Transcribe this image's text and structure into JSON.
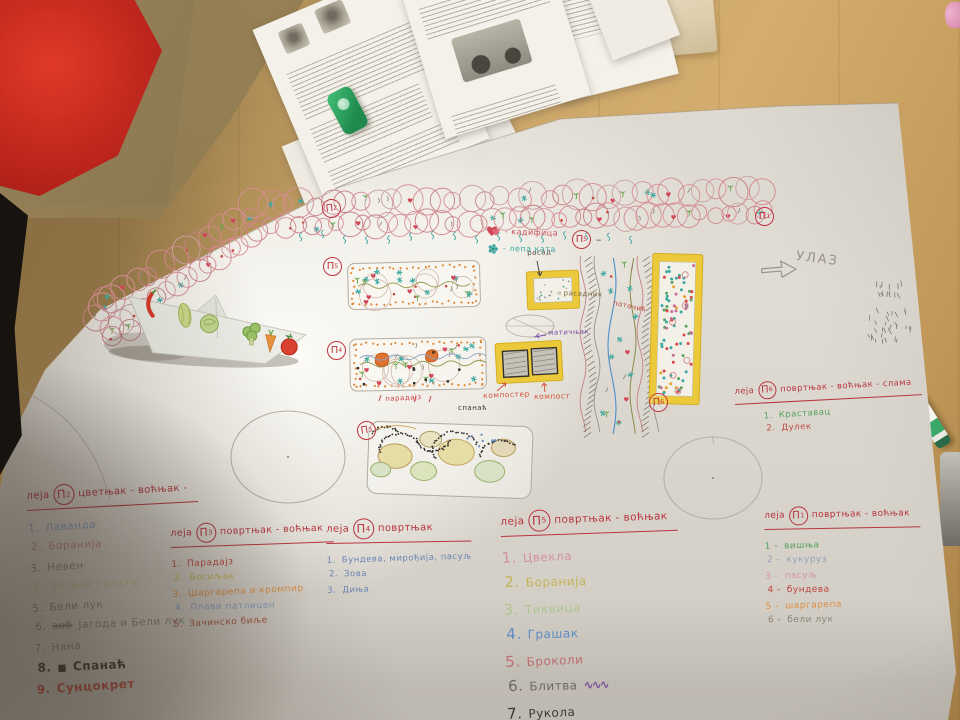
{
  "scene": {
    "desk_color": "#c9a466",
    "table_left_color": "#8a774e",
    "cloth_color": "#b5221a",
    "poster_color": "#e0dcd4",
    "accent_yellow": "#ecc93a",
    "marker_red": "#c0353f",
    "marker_teal": "#3aa8a0"
  },
  "plan": {
    "entrance_label": "УЛАЗ",
    "legend": [
      {
        "icon": "heart-icon",
        "color": "#d04858",
        "label": "- кадифица"
      },
      {
        "icon": "flower-icon",
        "color": "#3aa8a0",
        "label": "- лепа ката"
      }
    ],
    "annotations": {
      "rasad": "расад",
      "rasadnik": "◃ расадник",
      "potocic": "поточић",
      "maticnjak": "матичњак",
      "komposter": "компостер",
      "kompost": "компост",
      "spanac": "спанаћ",
      "paradajz": "парадајз"
    },
    "markers": [
      {
        "letter": "П",
        "num": "2"
      },
      {
        "letter": "П",
        "num": "1"
      },
      {
        "letter": "П",
        "num": "5"
      },
      {
        "letter": "П",
        "num": "4"
      },
      {
        "letter": "П",
        "num": "3"
      },
      {
        "letter": "П",
        "num": "6"
      },
      {
        "letter": "П",
        "num": "5",
        "dash": "–"
      }
    ]
  },
  "lists": [
    {
      "prefix": "леја",
      "marker": {
        "letter": "П",
        "num": "2"
      },
      "title": "цветњак - воћњак -",
      "items": [
        {
          "n": "1.",
          "text": "Лаванда",
          "color": "#87a0c6"
        },
        {
          "n": "2.",
          "text": "Боранија",
          "color": "#c08878"
        },
        {
          "n": "3.",
          "text": "Невен",
          "color": "#8b857a"
        },
        {
          "n": "4.",
          "text": "Зелена салата",
          "color": "#b9c693"
        },
        {
          "n": "5.",
          "text": "Бели лук",
          "color": "#8b857a"
        },
        {
          "n": "6.",
          "strike": "зоб",
          "text": "Јагода и Бели лук",
          "color": "#8b857a"
        },
        {
          "n": "7.",
          "text": "Нана",
          "color": "#8b857a"
        },
        {
          "n": "8.",
          "bullet": "■",
          "text": "Спанаћ",
          "color": "#33312d",
          "big": true
        },
        {
          "n": "9.",
          "text": "Сунцокрет",
          "color": "#c0453c",
          "big": true
        }
      ]
    },
    {
      "prefix": "леја",
      "marker": {
        "letter": "П",
        "num": "3"
      },
      "title": "повртњак - воћњак",
      "items": [
        {
          "n": "1.",
          "text": "Парадајз",
          "color": "#c0453c"
        },
        {
          "n": "2.",
          "text": "Босиљак",
          "color": "#c4b456"
        },
        {
          "n": "3.",
          "text": "Шаргарепа и кромпир",
          "color": "#dd8f45"
        },
        {
          "n": "4.",
          "text": "Плави патлиџан",
          "color": "#87a0c6"
        },
        {
          "n": "5.",
          "text": "Зачинско биље",
          "color": "#a4523e"
        }
      ]
    },
    {
      "prefix": "леја",
      "marker": {
        "letter": "П",
        "num": "4"
      },
      "title": "повртњак",
      "items": [
        {
          "n": "1.",
          "text": "Бундева, мирођија, пасуљ",
          "color": "#6b85b5"
        },
        {
          "n": "2.",
          "text": "Зова",
          "color": "#6b85b5"
        },
        {
          "n": "3.",
          "text": "Диња",
          "color": "#6b85b5"
        }
      ]
    },
    {
      "prefix": "леја",
      "marker": {
        "letter": "П",
        "num": "5"
      },
      "title": "повртњак - воћњак",
      "items": [
        {
          "n": "1.",
          "text": "Цвекла",
          "color": "#d391a4"
        },
        {
          "n": "2.",
          "text": "Боранија",
          "color": "#c4b456"
        },
        {
          "n": "3.",
          "text": "Тиквица",
          "color": "#afc490"
        },
        {
          "n": "4.",
          "text": "Грашак",
          "color": "#5b8cc8"
        },
        {
          "n": "5.",
          "text": "Броколи",
          "color": "#c47070"
        },
        {
          "n": "6.",
          "text": "Блитва",
          "color": "#6f6b62",
          "scribble": "#7a4fa8"
        },
        {
          "n": "7.",
          "text": "Рукола",
          "color": "#33312d"
        }
      ]
    },
    {
      "prefix": "леја",
      "marker": {
        "letter": "П",
        "num": "6"
      },
      "title": "повртњак - воћњак - слама",
      "items": [
        {
          "n": "1.",
          "text": "Краставац",
          "color": "#57a35f"
        },
        {
          "n": "2.",
          "text": "Дулек",
          "color": "#c0453c"
        }
      ]
    },
    {
      "prefix": "леја",
      "marker": {
        "letter": "П",
        "num": "1"
      },
      "title": "повртњак - воћњак",
      "items": [
        {
          "n": "1 -",
          "text": "вишња",
          "color": "#57a35f"
        },
        {
          "n": "2 -",
          "text": "кукуруз",
          "color": "#93a3b5"
        },
        {
          "n": "3 -",
          "text": "пасуљ",
          "color": "#d391a4"
        },
        {
          "n": "4 -",
          "text": "бундева",
          "color": "#c0453c"
        },
        {
          "n": "5 -",
          "text": "шаргарепа",
          "color": "#dd8f45"
        },
        {
          "n": "6 -",
          "text": "бели лук",
          "color": "#8b857a"
        }
      ]
    }
  ]
}
